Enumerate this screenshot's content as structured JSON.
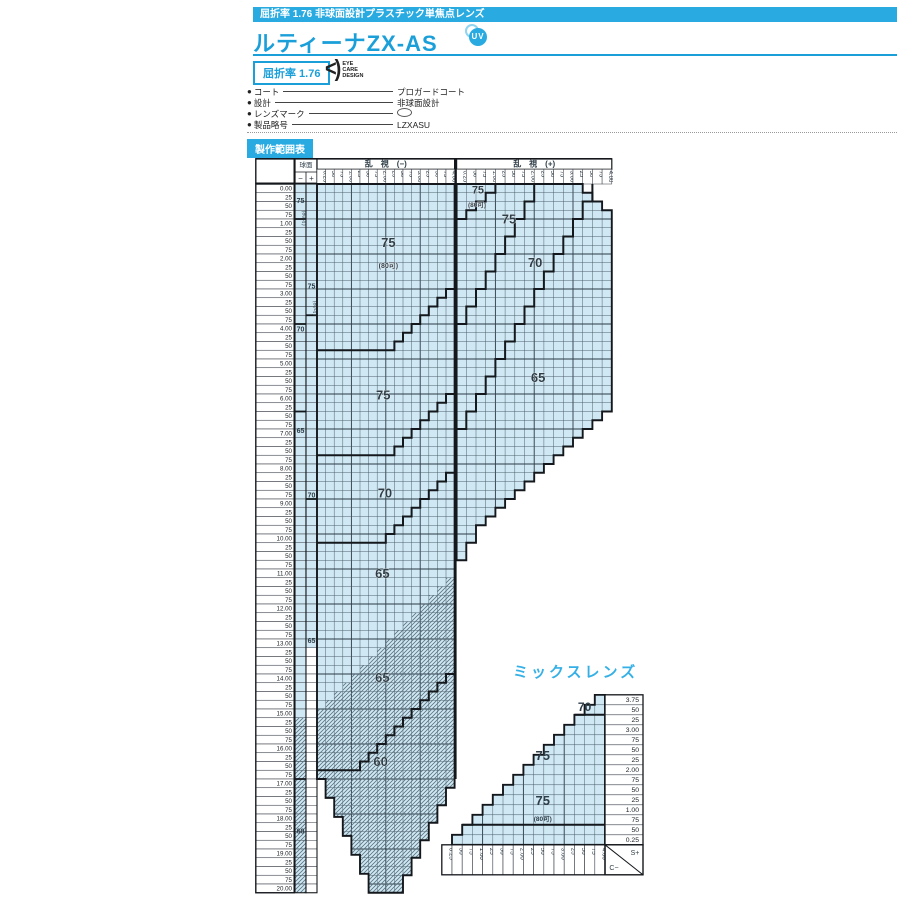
{
  "page": {
    "topbar": "屈折率 1.76 非球面設計プラスチック単焦点レンズ",
    "title": "ルティーナZX-AS",
    "uv_label": "UV",
    "index_box": "屈折率 1.76",
    "logo": {
      "glyph": "<)",
      "lines": [
        "EYE",
        "CARE",
        "DESIGN"
      ]
    },
    "specs": [
      {
        "label": "コート",
        "value": "プロガードコート",
        "icon": ""
      },
      {
        "label": "設計",
        "value": "非球面設計",
        "icon": ""
      },
      {
        "label": "レンズマーク",
        "value": "",
        "icon": "lens-mark"
      },
      {
        "label": "製品略号",
        "value": "LZXASU",
        "icon": ""
      }
    ],
    "section_badge": "製作範囲表"
  },
  "colors": {
    "accent": "#29abe2",
    "title_blue": "#1b9fd9",
    "fill": "#cfe8f3",
    "grid": "#41525e",
    "grid_major": "#2b3a44",
    "line": "#14181c",
    "hatch": "#5b7280",
    "label": "#2e3d47",
    "cell_border": "#333941"
  },
  "chart_data": [
    {
      "type": "table",
      "name": "production-range",
      "sphere_header": "球面",
      "sign_minus": "−",
      "sign_plus": "+",
      "cyl_minus_header": "乱　視　(−)",
      "cyl_plus_header": "乱　視　(+)",
      "col_labels": [
        "0.25",
        "50",
        "75",
        "1.00",
        "25",
        "50",
        "75",
        "2.00",
        "25",
        "50",
        "75",
        "3.00",
        "25",
        "50",
        "75",
        "4.00"
      ],
      "row_labels": [
        "0.00",
        "25",
        "50",
        "75",
        "1.00",
        "25",
        "50",
        "75",
        "2.00",
        "25",
        "50",
        "75",
        "3.00",
        "25",
        "50",
        "75",
        "4.00",
        "25",
        "50",
        "75",
        "5.00",
        "25",
        "50",
        "75",
        "6.00",
        "25",
        "50",
        "75",
        "7.00",
        "25",
        "50",
        "75",
        "8.00",
        "25",
        "50",
        "75",
        "9.00",
        "25",
        "50",
        "75",
        "10.00",
        "25",
        "50",
        "75",
        "11.00",
        "25",
        "50",
        "75",
        "12.00",
        "25",
        "50",
        "75",
        "13.00",
        "25",
        "50",
        "75",
        "14.00",
        "25",
        "50",
        "75",
        "15.00",
        "25",
        "50",
        "75",
        "16.00",
        "25",
        "50",
        "75",
        "17.00",
        "25",
        "50",
        "75",
        "18.00",
        "25",
        "50",
        "75",
        "19.00",
        "25",
        "50",
        "75",
        "20.00"
      ],
      "minus_half": {
        "outline": [
          [
            "M",
            0,
            0
          ],
          [
            "L",
            16,
            0
          ],
          [
            "L",
            16,
            67
          ],
          [
            "S",
            9,
            81
          ],
          [
            "L",
            6,
            81
          ],
          [
            "S",
            0,
            68
          ],
          [
            "L",
            0,
            0
          ],
          [
            "Z"
          ]
        ],
        "hatch": [
          [
            "M",
            0,
            61
          ],
          [
            "S",
            16,
            45
          ],
          [
            "L",
            16,
            67
          ],
          [
            "S",
            9,
            81
          ],
          [
            "L",
            6,
            81
          ],
          [
            "S",
            0,
            68
          ],
          [
            "Z"
          ]
        ],
        "boundaries": [
          [
            [
              "M",
              0,
              19
            ],
            [
              "L",
              9,
              19
            ],
            [
              "S",
              16,
              12
            ]
          ],
          [
            [
              "M",
              0,
              31
            ],
            [
              "L",
              9,
              31
            ],
            [
              "S",
              16,
              24
            ]
          ],
          [
            [
              "M",
              0,
              41
            ],
            [
              "L",
              8,
              41
            ],
            [
              "S",
              16,
              33
            ]
          ],
          [
            [
              "M",
              0,
              67
            ],
            [
              "L",
              5,
              67
            ],
            [
              "S",
              16,
              56
            ]
          ]
        ],
        "labels": [
          {
            "t": "75",
            "u": 8.3,
            "v": 7.2,
            "s": 13
          },
          {
            "t": "(80可)",
            "u": 8.3,
            "v": 9.6,
            "s": 7
          },
          {
            "t": "75",
            "u": 7.7,
            "v": 24.6,
            "s": 13
          },
          {
            "t": "70",
            "u": 7.9,
            "v": 35.8,
            "s": 13
          },
          {
            "t": "65",
            "u": 7.6,
            "v": 45.0,
            "s": 13
          },
          {
            "t": "65",
            "u": 7.6,
            "v": 56.9,
            "s": 13
          },
          {
            "t": "60",
            "u": 7.4,
            "v": 66.5,
            "s": 13
          }
        ]
      },
      "plus_half": {
        "outline": [
          [
            "M",
            0,
            0
          ],
          [
            "L",
            13,
            0
          ],
          [
            "S",
            16,
            3
          ],
          [
            "L",
            16,
            25
          ],
          [
            "S",
            2,
            39
          ],
          [
            "S",
            0,
            43
          ],
          [
            "L",
            0,
            0
          ],
          [
            "Z"
          ]
        ],
        "boundaries": [
          [
            [
              "M",
              4,
              0
            ],
            [
              "S",
              0,
              4
            ]
          ],
          [
            [
              "M",
              8,
              0
            ],
            [
              "S",
              0,
              16
            ]
          ],
          [
            [
              "M",
              14,
              0
            ],
            [
              "S",
              0,
              28
            ]
          ]
        ],
        "labels": [
          {
            "t": "75",
            "u": 2.2,
            "v": 1.1,
            "s": 11
          },
          {
            "t": "(80可)",
            "u": 2.1,
            "v": 2.6,
            "s": 6.5
          },
          {
            "t": "75",
            "u": 5.4,
            "v": 4.5,
            "s": 13
          },
          {
            "t": "70",
            "u": 8.1,
            "v": 9.5,
            "s": 13
          },
          {
            "t": "65",
            "u": 8.4,
            "v": 22.6,
            "s": 13
          }
        ]
      },
      "sphere_cols": {
        "minus": {
          "colored_to": 81,
          "hatch_from": 61,
          "lines": [
            4,
            16,
            26,
            68
          ],
          "ann": [
            {
              "v": 1.9,
              "t": "75",
              "rot": false
            },
            {
              "v": 3.9,
              "t": "(80可)",
              "rot": true
            },
            {
              "v": 16.6,
              "t": "70",
              "rot": false
            },
            {
              "v": 28.2,
              "t": "65",
              "rot": false
            },
            {
              "v": 74.0,
              "t": "60",
              "rot": false
            }
          ]
        },
        "plus": {
          "colored_to": 53,
          "hatch_from": 999,
          "lines": [
            15,
            36
          ],
          "ann": [
            {
              "v": 11.7,
              "t": "75",
              "rot": false
            },
            {
              "v": 14.2,
              "t": "(80可)",
              "rot": true
            },
            {
              "v": 35.6,
              "t": "70",
              "rot": false
            },
            {
              "v": 52.2,
              "t": "65",
              "rot": false
            }
          ]
        }
      }
    },
    {
      "type": "table",
      "name": "mix-lens",
      "title": "ミックスレンズ",
      "col_labels": [
        "0.25",
        "50",
        "75",
        "1.00",
        "25",
        "50",
        "75",
        "2.00",
        "25",
        "50",
        "75",
        "3.00",
        "25",
        "50",
        "75",
        "4.00"
      ],
      "row_labels_right_top_to_bottom": [
        "3.75",
        "50",
        "25",
        "3.00",
        "75",
        "50",
        "25",
        "2.00",
        "75",
        "50",
        "25",
        "1.00",
        "75",
        "50",
        "0.25"
      ],
      "corner": {
        "top": "S+",
        "bottom": "C−"
      },
      "outline": [
        [
          "M",
          1,
          15
        ],
        [
          "S",
          15,
          1
        ],
        [
          "L",
          15,
          0
        ],
        [
          "L",
          16,
          0
        ],
        [
          "L",
          16,
          15
        ],
        [
          "L",
          1,
          15
        ],
        [
          "Z"
        ]
      ],
      "boundaries": [
        [
          [
            "M",
            2,
            13
          ],
          [
            "L",
            16,
            13
          ]
        ],
        [
          [
            "M",
            13,
            2
          ],
          [
            "L",
            16,
            2
          ]
        ]
      ],
      "labels": [
        {
          "t": "70",
          "u": 14.0,
          "v": 1.6,
          "s": 12
        },
        {
          "t": "75",
          "u": 9.9,
          "v": 6.5,
          "s": 13
        },
        {
          "t": "75",
          "u": 9.9,
          "v": 11.0,
          "s": 13
        },
        {
          "t": "(80可)",
          "u": 9.9,
          "v": 12.6,
          "s": 6.5
        }
      ]
    }
  ]
}
